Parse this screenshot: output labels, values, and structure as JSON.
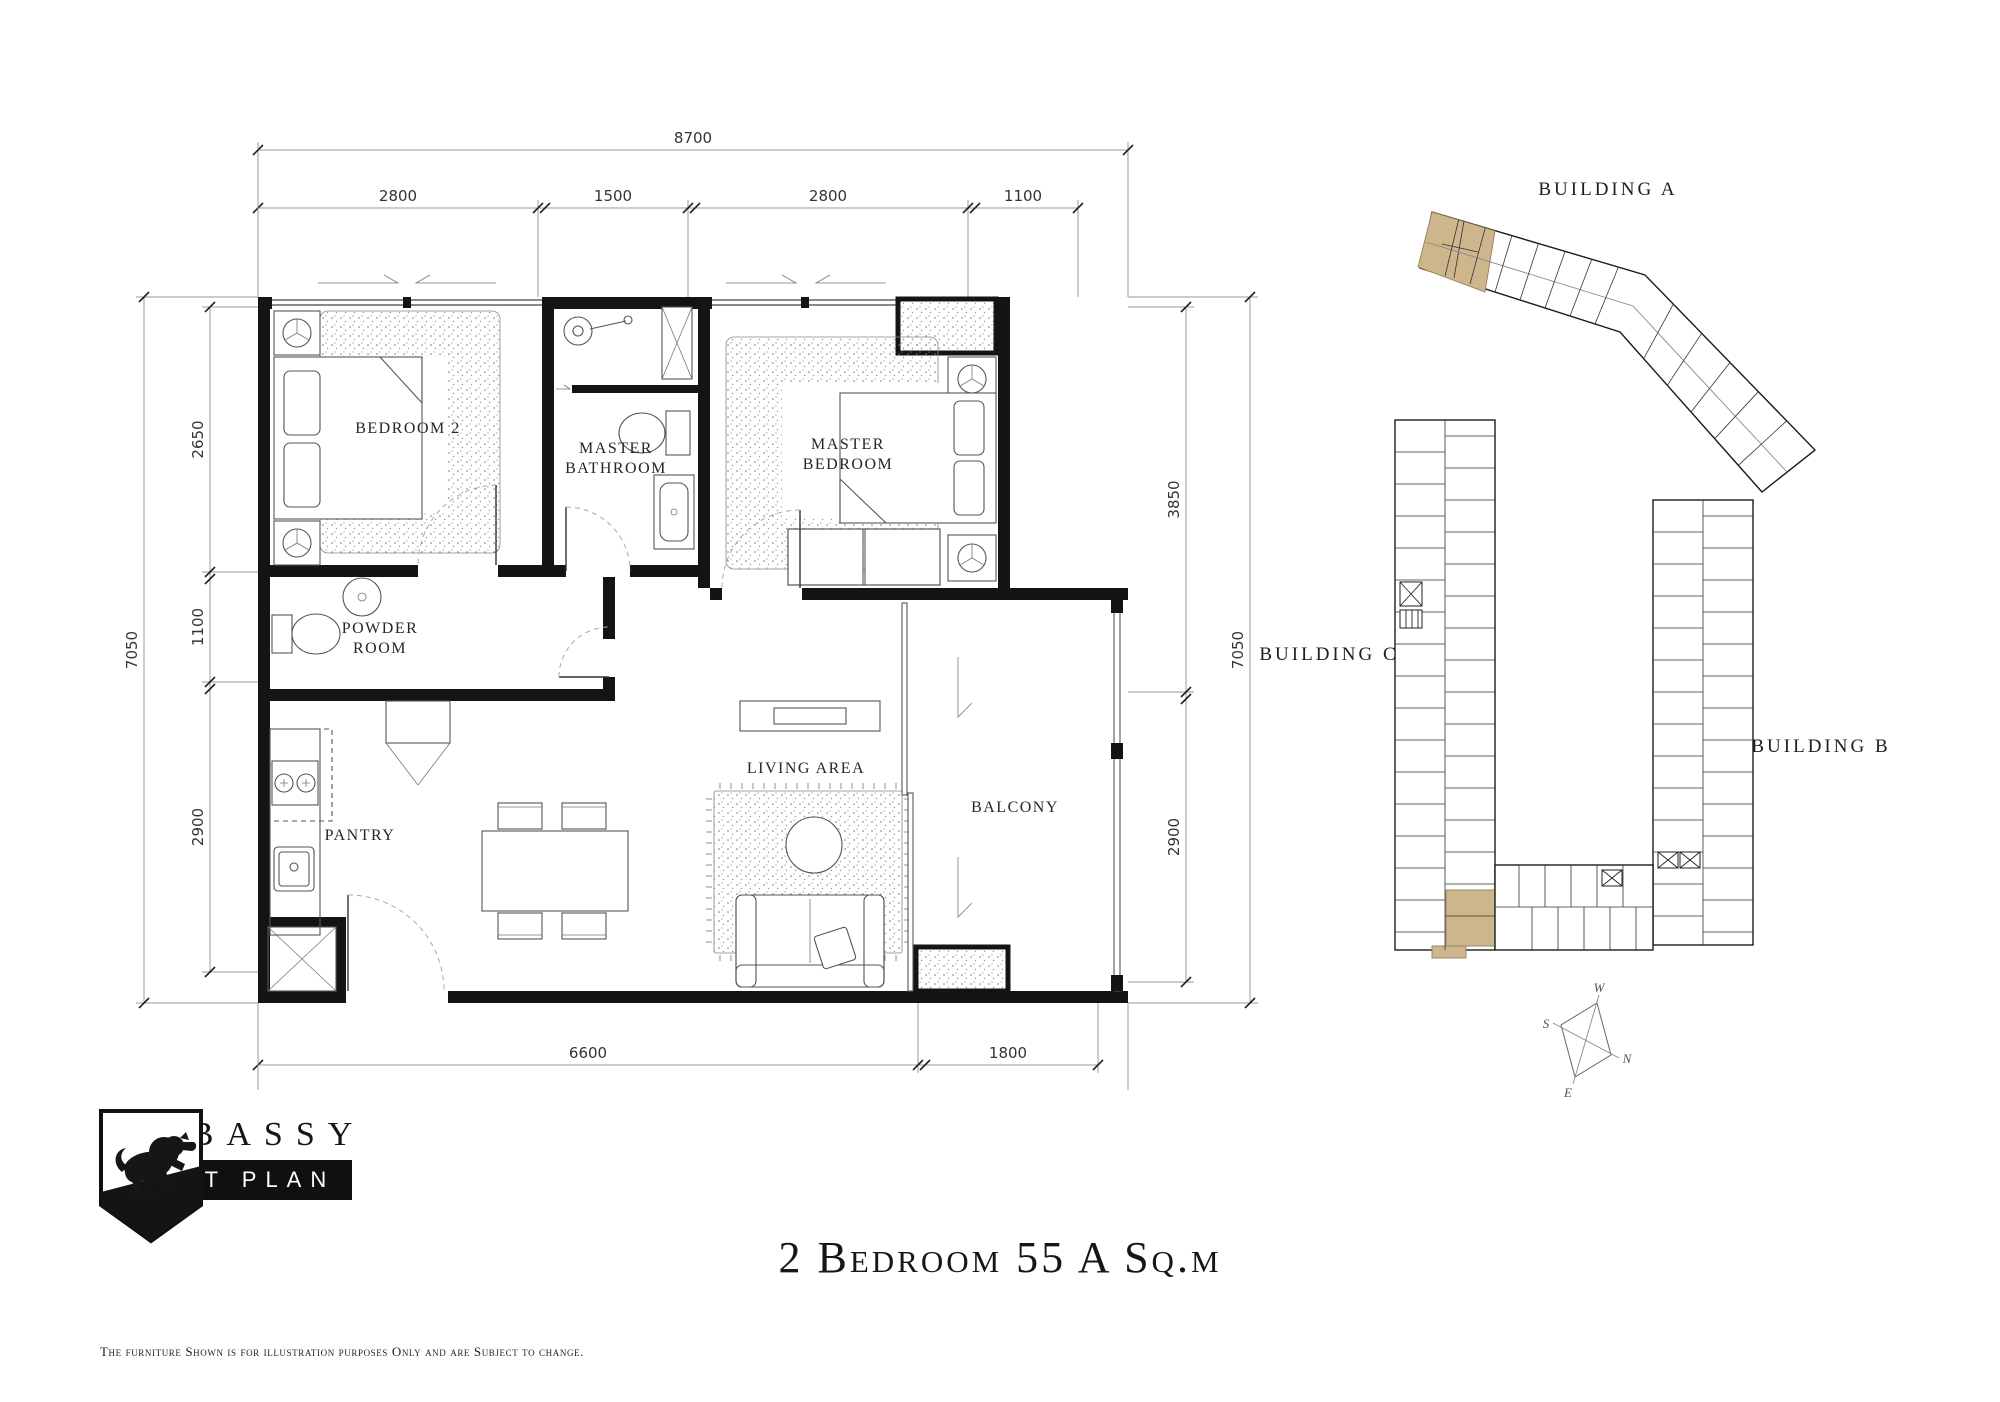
{
  "title": "2 Bedroom 55 A Sq.m",
  "brand": {
    "name": "EMBASSY",
    "plan_type": "UNIT PLAN",
    "disclaimer": "The furniture Shown is for illustration purposes Only and are Subject to change."
  },
  "rooms": {
    "bedroom2": "BEDROOM 2",
    "master_bathroom_line1": "MASTER",
    "master_bathroom_line2": "BATHROOM",
    "master_bedroom_line1": "MASTER",
    "master_bedroom_line2": "BEDROOM",
    "powder_line1": "POWDER",
    "powder_line2": "ROOM",
    "pantry": "PANTRY",
    "living": "LIVING AREA",
    "balcony": "BALCONY"
  },
  "dimensions": {
    "top_total": "8700",
    "top_segments": [
      "2800",
      "1500",
      "2800",
      "1100"
    ],
    "left_total": "7050",
    "left_segments": [
      "2650",
      "1100",
      "2900"
    ],
    "right_total": "7050",
    "right_segments": [
      "3850",
      "2900"
    ],
    "bottom_total": "8700",
    "bottom_segments": [
      "6600",
      "1800"
    ]
  },
  "key_plan": {
    "building_a": "BUILDING A",
    "building_b": "BUILDING B",
    "building_c": "BUILDING C",
    "highlight_color": "#CDB58C"
  },
  "compass": {
    "top": "W",
    "left": "S",
    "right": "N",
    "bottom": "E"
  }
}
